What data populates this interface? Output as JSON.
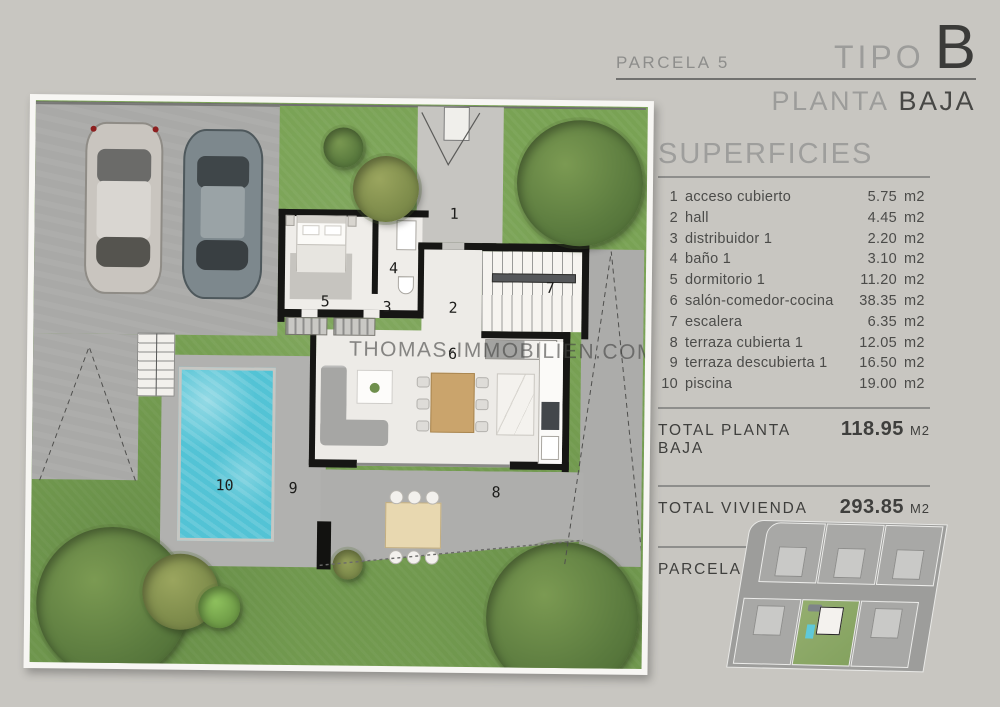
{
  "header": {
    "parcela": "PARCELA 5",
    "tipo_label": "TIPO",
    "tipo_value": "B",
    "planta_label": "PLANTA",
    "planta_value": "BAJA"
  },
  "superficies": {
    "title": "SUPERFICIES",
    "rows": [
      {
        "num": "1",
        "label": "acceso cubierto",
        "value": "5.75",
        "unit": "m2"
      },
      {
        "num": "2",
        "label": "hall",
        "value": "4.45",
        "unit": "m2"
      },
      {
        "num": "3",
        "label": "distribuidor 1",
        "value": "2.20",
        "unit": "m2"
      },
      {
        "num": "4",
        "label": "baño 1",
        "value": "3.10",
        "unit": "m2"
      },
      {
        "num": "5",
        "label": "dormitorio 1",
        "value": "11.20",
        "unit": "m2"
      },
      {
        "num": "6",
        "label": "salón-comedor-cocina",
        "value": "38.35",
        "unit": "m2"
      },
      {
        "num": "7",
        "label": "escalera",
        "value": "6.35",
        "unit": "m2"
      },
      {
        "num": "8",
        "label": "terraza cubierta 1",
        "value": "12.05",
        "unit": "m2"
      },
      {
        "num": "9",
        "label": "terraza descubierta 1",
        "value": "16.50",
        "unit": "m2"
      },
      {
        "num": "10",
        "label": "piscina",
        "value": "19.00",
        "unit": "m2"
      }
    ],
    "totals": [
      {
        "label": "TOTAL PLANTA BAJA",
        "value": "118.95",
        "unit": "M2"
      },
      {
        "label": "TOTAL VIVIENDA",
        "value": "293.85",
        "unit": "M2"
      },
      {
        "label": "PARCELA",
        "value": "393.55",
        "unit": "M2"
      }
    ]
  },
  "plan": {
    "watermark": "THOMAS-IMMOBILIEN.COM",
    "labels": [
      "1",
      "2",
      "3",
      "4",
      "5",
      "6",
      "7",
      "8",
      "9",
      "10"
    ],
    "colors": {
      "pool": "#53c3d5",
      "grass": "#79a254",
      "concrete": "#a9a9a7",
      "interior_floor": "#edebe7",
      "wall": "#161614",
      "background": "#c8c6c1"
    }
  }
}
